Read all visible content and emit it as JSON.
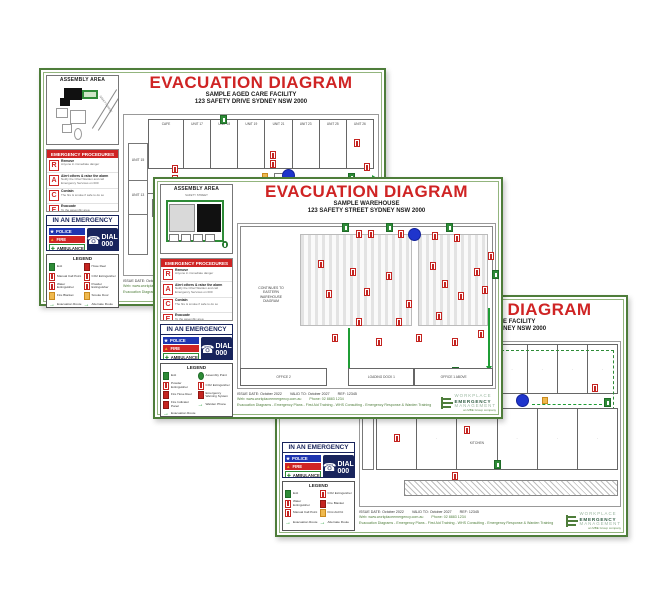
{
  "colors": {
    "accent_red": "#cf2424",
    "border_green": "#4e7d3a",
    "navy": "#18245c",
    "police_blue": "#1e35b0",
    "exit_green": "#2e8b37",
    "route_green": "#1f9d35",
    "marker_blue": "#1f35cc",
    "amber": "#efb94e"
  },
  "shared": {
    "assembly_header": "ASSEMBLY AREA",
    "procedures_header": "EMERGENCY PROCEDURES",
    "emergency_header": "IN AN EMERGENCY",
    "legend_header": "LEGEND",
    "police": "POLICE",
    "fire": "FIRE",
    "ambulance": "AMBULANCE",
    "dial": "DIAL",
    "dial_number": "000",
    "race": [
      {
        "letter": "R",
        "title": "Remove",
        "sub": "Anyone in immediate danger"
      },
      {
        "letter": "A",
        "title": "Alert others & raise the alarm",
        "sub": "Notify the Chief Warden and call Emergency Services on 000"
      },
      {
        "letter": "C",
        "title": "Contain",
        "sub": "The fire & smoke if safe to do so"
      },
      {
        "letter": "E",
        "title": "Evacuate",
        "sub": "To the assembly area"
      }
    ],
    "footer": {
      "issue": "ISSUE DATE: October 2022",
      "valid": "VALID TO: October 2027",
      "ref": "REF: 12345",
      "web": "Web: www.workplaceemergency.com.au",
      "phone": "Phone: 02 8883 1234",
      "services": "Evacuation Diagrams  -  Emergency Plans  -  First Aid Training  -  WHS Consulting  -  Emergency Response & Warden Training"
    },
    "logo": {
      "line1": "WORKPLACE",
      "line2": "EMERGENCY",
      "line3": "MANAGEMENT",
      "tagline": "an MBE Group company"
    }
  },
  "pages": [
    {
      "title": "EVACUATION DIAGRAM",
      "subtitle1": "SAMPLE AGED CARE FACILITY",
      "subtitle2": "123 SAFETY DRIVE SYDNEY NSW 2000",
      "assembly_street": "SAFETY DRIVE",
      "plan": {
        "rooms_top": [
          "CAFE",
          "UNIT 17",
          "UNIT 18",
          "UNIT 19",
          "UNIT 21",
          "UNIT 23",
          "UNIT 25",
          "UNIT 26"
        ],
        "unit15": "UNIT 15",
        "unit13": "UNIT 13",
        "store": "STORE",
        "lift": "LIFT"
      },
      "legend_left": [
        "Exit",
        "Manual Call Point",
        "Water Extinguisher",
        "Fire Blanket",
        "Evacuation Route"
      ],
      "legend_right": [
        "Hose Reel",
        "CO2 Extinguisher",
        "Powder Extinguisher",
        "Smoke Door",
        "Alternate Route"
      ]
    },
    {
      "title": "EVACUATION DIAGRAM",
      "subtitle1": "SAMPLE WAREHOUSE",
      "subtitle2": "123 SAFETY STREET SYDNEY NSW 2000",
      "assembly_street": "SAFETY STREET",
      "plan": {
        "continues": [
          "CONTINUES TO",
          "EASTERN",
          "WAREHOUSE",
          "DIAGRAM"
        ],
        "office2": "OFFICE 2",
        "loading": "LOADING DOCK 1",
        "office1": "OFFICE 1 ABOVE"
      },
      "legend_left": [
        "Exit",
        "Powder Extinguisher",
        "Fire Hose Reel",
        "Fire Indicator Panel",
        "Evacuation Route"
      ],
      "legend_right": [
        "Assembly Point",
        "CO2 Extinguisher",
        "Emergency Warning System",
        "Warden Phone"
      ]
    },
    {
      "title": "EVACUATION DIAGRAM",
      "subtitle1": "SAMPLE AGED CARE FACILITY",
      "subtitle2": "123 SAFETY DRIVE SYDNEY NSW 2000",
      "plan": {
        "kitchen": "KITCHEN"
      },
      "legend_left": [
        "Exit",
        "Water Extinguisher",
        "Manual Call Point",
        "Evacuation Route"
      ],
      "legend_right": [
        "CO2 Extinguisher",
        "Fire Blanket",
        "First Aid Kit",
        "Alternate Route"
      ]
    }
  ]
}
